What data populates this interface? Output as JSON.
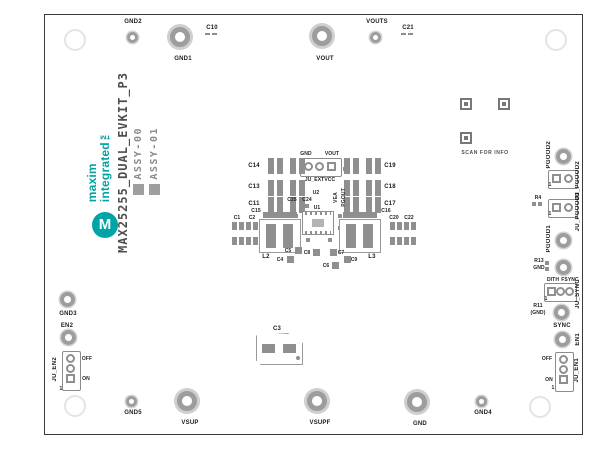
{
  "colors": {
    "teal": "#00A3A6",
    "pad_gray": "#9d9d9d",
    "silkscreen": "#1b1b1b",
    "board_outline": "#3a3a3a"
  },
  "branding": {
    "logo_line1": "maxim",
    "logo_line2": "integrated™",
    "monogram": "M",
    "board_title": "MAX25255_DUAL_EVKIT_P3",
    "assy_00": "ASSY-00",
    "assy_01": "ASSY-01"
  },
  "qr": {
    "caption": "SCAN FOR INFO"
  },
  "edge": {
    "gnd2": "GND2",
    "gnd1": "GND1",
    "c10": "C10",
    "vout": "VOUT",
    "vouts": "VOUTS",
    "c21": "C21",
    "gnd3": "GND3",
    "en2": "EN2",
    "ju_en2": "JU_EN2",
    "gnd5": "GND5",
    "vsup": "VSUP",
    "vsupf": "VSUPF",
    "gnd": "GND",
    "gnd4": "GND4",
    "pgood2": "PGOOD2",
    "ju_pgood2": "JU_PGOOD2",
    "r4": "R4",
    "ju_pgood1": "JU_PGOOD1",
    "pgood1": "PGOOD1",
    "r13": "R13",
    "r13_net": "GND",
    "dith": "DITH",
    "fsync": "FSYNC",
    "ju_sync": "JU_SYNC",
    "r11": "R11",
    "r11_net": "(GND)",
    "sync": "SYNC",
    "en1": "EN1",
    "ju_en1": "JU_EN1",
    "off": "OFF",
    "on": "ON",
    "pin1": "1"
  },
  "center": {
    "ju_extvcc": "JU_EXTVCC",
    "extvcc_gnd": "GND",
    "extvcc_vout": "VOUT",
    "u2": "U2",
    "u1": "U1",
    "c14": "C14",
    "c13": "C13",
    "c11": "C11",
    "c19": "C19",
    "c18": "C18",
    "c17": "C17",
    "c15": "C15",
    "c16": "C16",
    "c25": "C25",
    "c24": "C24",
    "l2": "L2",
    "l3": "L3",
    "c1": "C1",
    "c2": "C2",
    "c20": "C20",
    "c22": "C22",
    "c5": "C5",
    "c4": "C4",
    "c8": "C8",
    "c7": "C7",
    "c9": "C9",
    "c6": "C6",
    "c3": "C3",
    "pgout": "PGOUT",
    "vea": "VEA"
  }
}
